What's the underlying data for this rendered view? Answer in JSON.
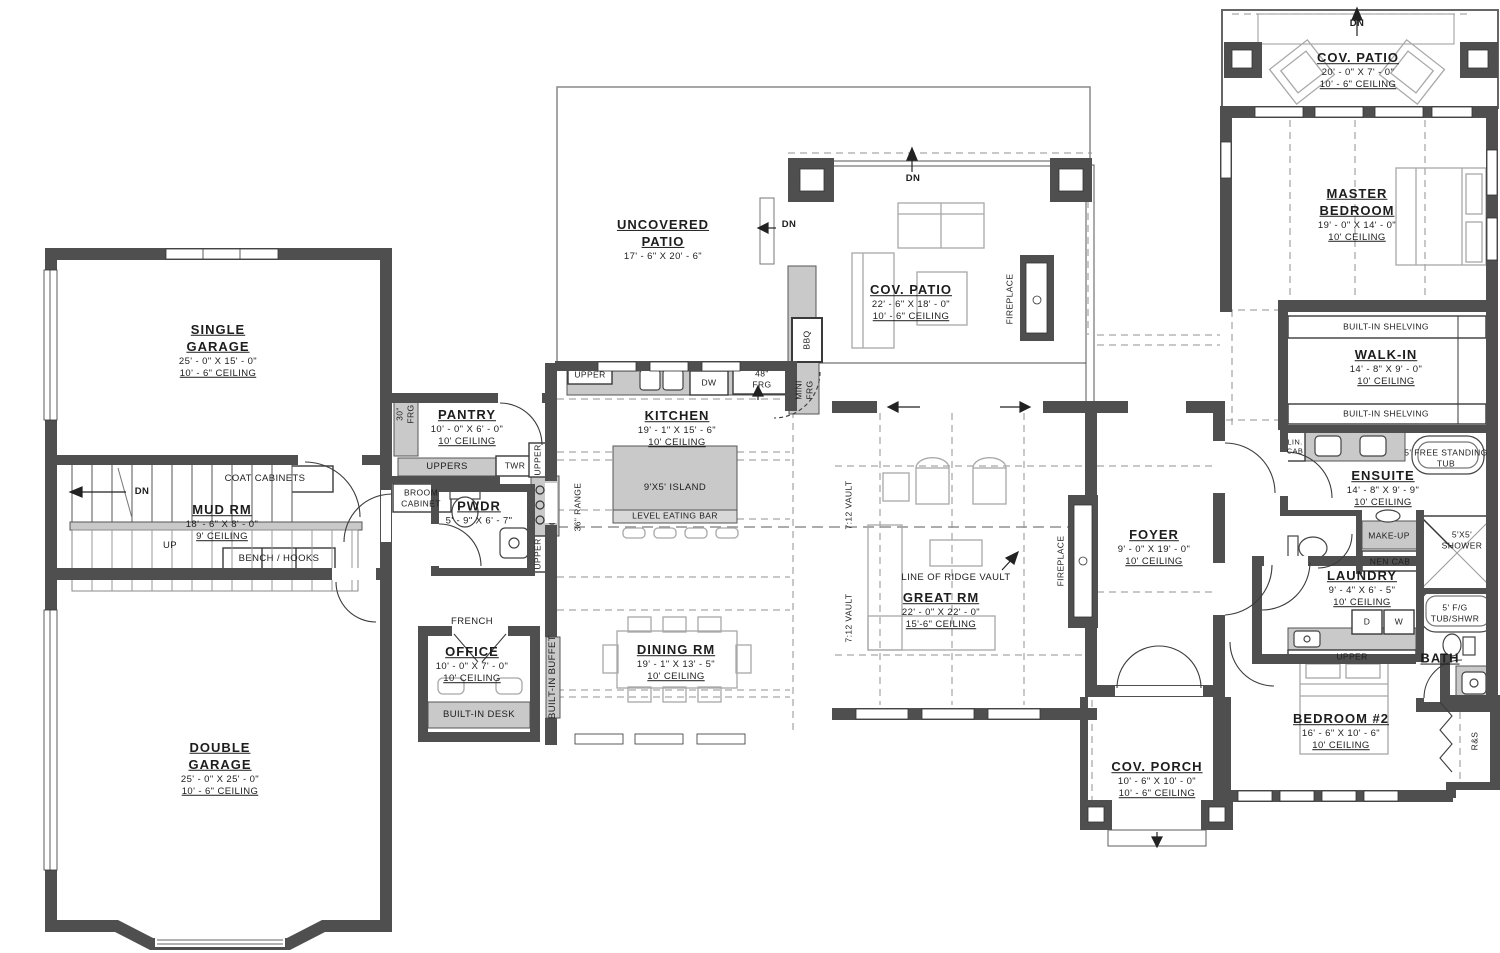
{
  "colors": {
    "wall": "#4f4f4f",
    "cabinet": "#c9c9c9",
    "furniture": "#a8a8a8",
    "dashed": "#909090"
  },
  "rooms": {
    "single_garage": {
      "title": "SINGLE GARAGE",
      "dims": "25' - 0\" X 15' - 0\"",
      "ceiling": "10' - 6\" CEILING"
    },
    "mud_rm": {
      "title": "MUD RM",
      "dims": "18' - 6\" X 8' - 0\"",
      "ceiling": "9' CEILING"
    },
    "double_garage": {
      "title": "DOUBLE GARAGE",
      "dims": "25' - 0\" X 25' - 0\"",
      "ceiling": "10' - 6\" CEILING"
    },
    "pantry": {
      "title": "PANTRY",
      "dims": "10' - 0\" X 6' - 0\"",
      "ceiling": "10' CEILING"
    },
    "pwdr": {
      "title": "PWDR",
      "dims": "5' - 9\" X 6' - 7\""
    },
    "office": {
      "title": "OFFICE",
      "dims": "10' - 0\" X 7' - 0\"",
      "ceiling": "10' CEILING"
    },
    "kitchen": {
      "title": "KITCHEN",
      "dims": "19' - 1\" X 15' - 6\"",
      "ceiling": "10' CEILING"
    },
    "dining": {
      "title": "DINING RM",
      "dims": "19' - 1\" X 13' - 5\"",
      "ceiling": "10' CEILING"
    },
    "uncovered_patio country": null,
    "uncovered_patio": {
      "title": "UNCOVERED PATIO",
      "dims": "17' - 6\" X 20' - 6\""
    },
    "cov_patio_main": {
      "title": "COV. PATIO",
      "dims": "22' - 6\" X 18' - 0\"",
      "ceiling": "10' - 6\" CEILING"
    },
    "great_rm": {
      "title": "GREAT RM",
      "dims": "22' - 0\" X 22' - 0\"",
      "ceiling": "15'-6\" CEILING"
    },
    "foyer": {
      "title": "FOYER",
      "dims": "9' - 0\" X 19' - 0\"",
      "ceiling": "10' CEILING"
    },
    "cov_porch": {
      "title": "COV. PORCH",
      "dims": "10' - 6\" X 10' - 0\"",
      "ceiling": "10' - 6\" CEILING"
    },
    "cov_patio_top": {
      "title": "COV. PATIO",
      "dims": "20' - 0\" X 7' - 0\"",
      "ceiling": "10' - 6\" CEILING"
    },
    "master": {
      "title": "MASTER BEDROOM",
      "dims": "19' - 0\" X 14' - 0\"",
      "ceiling": "10' CEILING"
    },
    "walk_in": {
      "title": "WALK-IN",
      "dims": "14' - 8\" X 9' - 0\"",
      "ceiling": "10' CEILING"
    },
    "ensuite": {
      "title": "ENSUITE",
      "dims": "14' - 8\" X 9' - 9\"",
      "ceiling": "10' CEILING"
    },
    "laundry": {
      "title": "LAUNDRY",
      "dims": "9' - 4\" X 6' - 5\"",
      "ceiling": "10' CEILING"
    },
    "bedroom2": {
      "title": "BEDROOM #2",
      "dims": "16' - 6\" X 10' - 6\"",
      "ceiling": "10' CEILING"
    },
    "bath": {
      "title": "BATH"
    }
  },
  "labels": {
    "dn": "DN",
    "up": "UP",
    "coat_cabinets": "COAT CABINETS",
    "bench_hooks": "BENCH / HOOKS",
    "frg30": "30\" FRG",
    "uppers": "UPPERS",
    "twr": "TWR",
    "broom_cabinet": "BROOM CABINET",
    "upper": "UPPER",
    "range36": "36\" RANGE",
    "island": "9'X5' ISLAND",
    "eating_bar": "LEVEL EATING BAR",
    "french": "FRENCH",
    "builtin_desk": "BUILT-IN DESK",
    "builtin_buffet": "BUILT-IN BUFFET",
    "dw": "DW",
    "frg48": "48\" FRG",
    "mini_frg": "MINI FRG",
    "bbq": "BBQ",
    "fireplace": "FIREPLACE",
    "ridge_vault": "LINE OF RIDGE VAULT",
    "vault712": "7:12 VAULT",
    "builtin_shelving": "BUILT-IN SHELVING",
    "lin_cab": "LIN. CAB",
    "free_tub": "5' FREE STANDING TUB",
    "makeup": "MAKE-UP",
    "linen_cab": "NEN CAB",
    "shower": "5'X5' SHOWER",
    "d": "D",
    "w": "W",
    "fg_tub": "5' F/G TUB/SHWR",
    "rs": "R&S"
  }
}
